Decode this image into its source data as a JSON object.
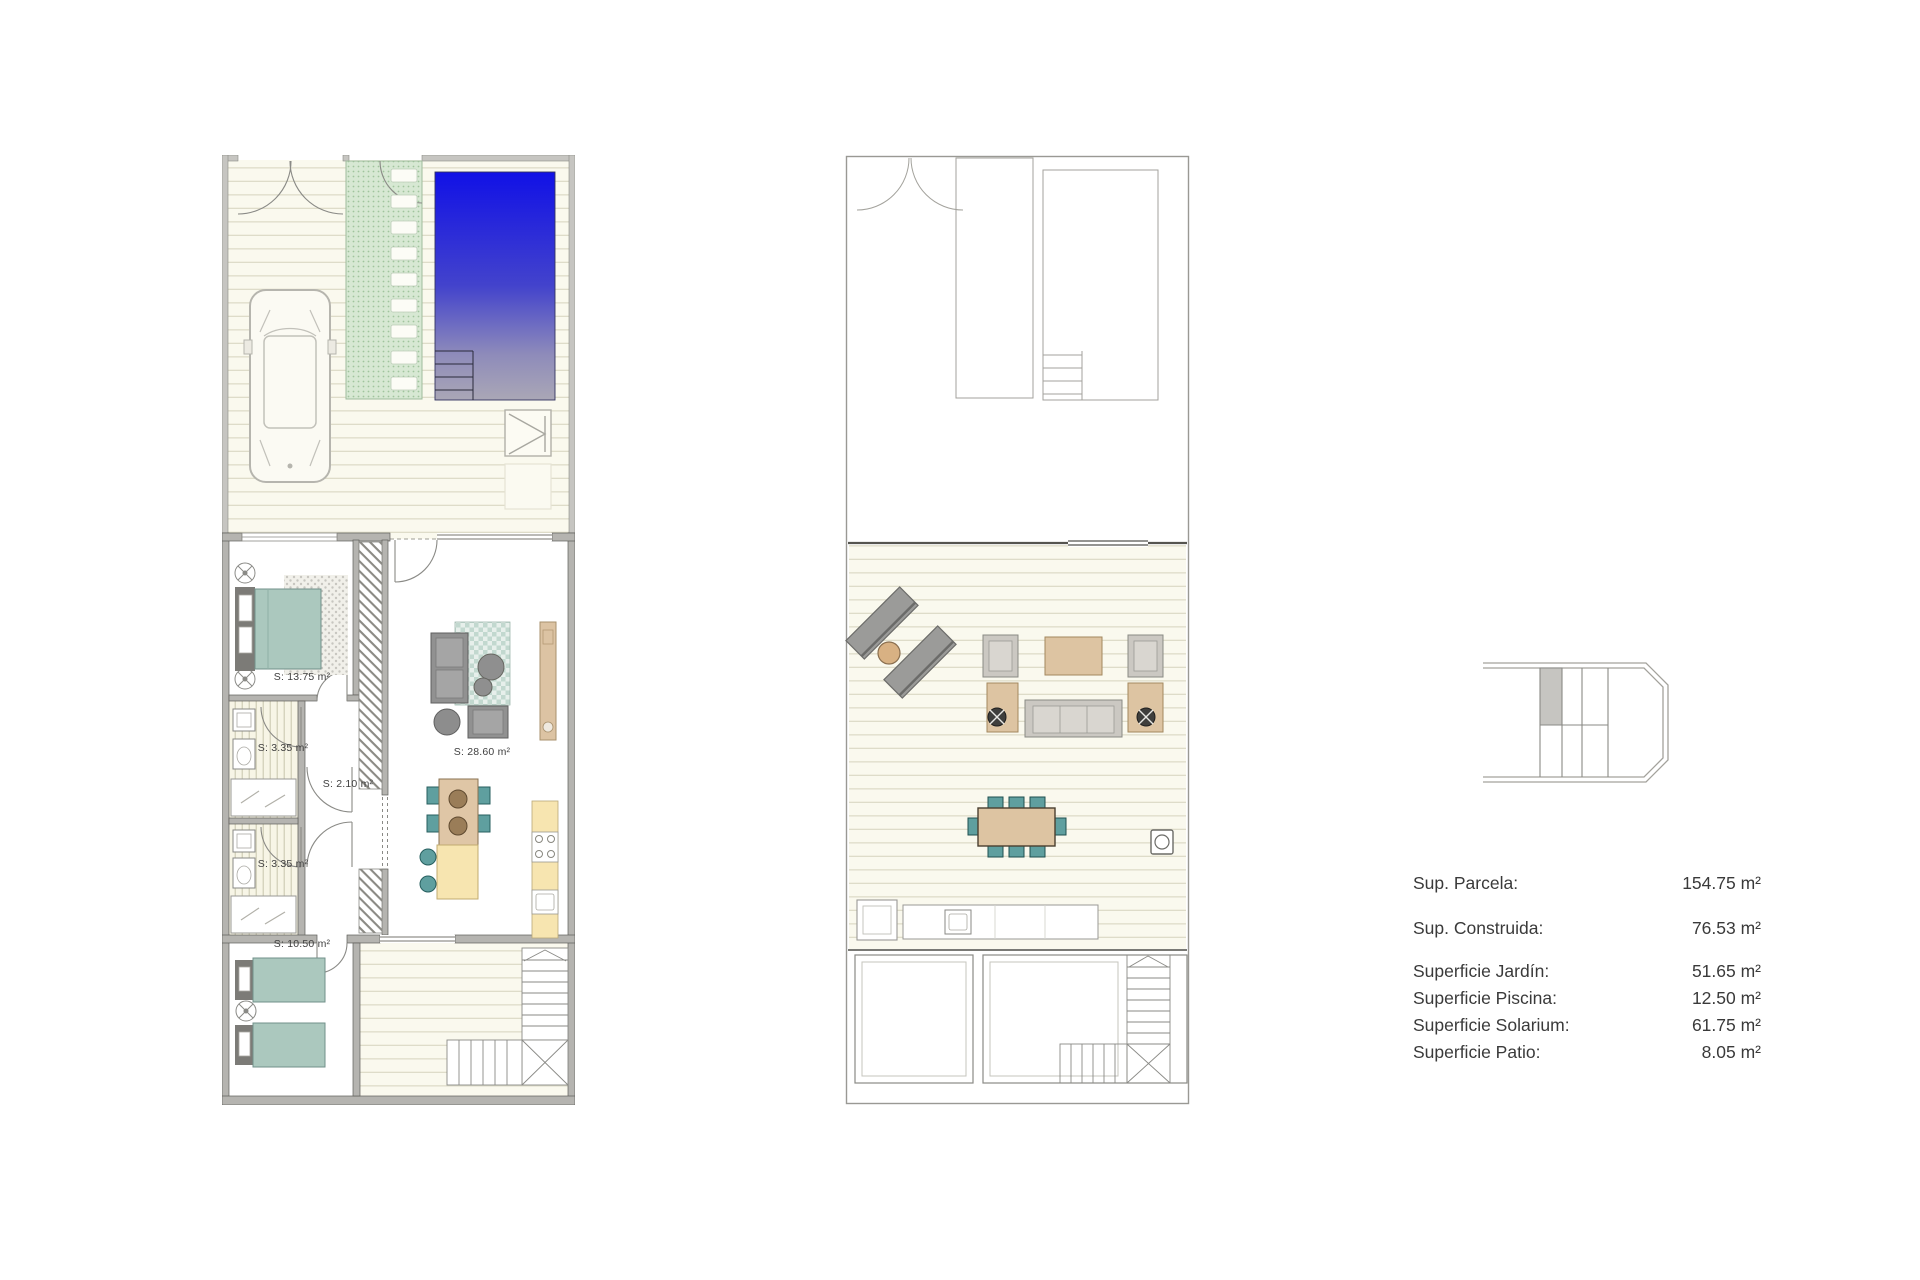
{
  "rooms": {
    "master_bedroom": "S: 13.75 m²",
    "bathroom_1": "S: 3.35 m²",
    "bathroom_2": "S: 3.35 m²",
    "hallway": "S: 2.10 m²",
    "living_kitchen": "S: 28.60 m²",
    "bedroom_2": "S: 10.50 m²"
  },
  "areas": [
    {
      "label": "Sup. Parcela:",
      "value": "154.75 m²"
    },
    {
      "label": "Sup. Construida:",
      "value": "76.53 m²"
    },
    {
      "label": "Superficie Jardín:",
      "value": "51.65 m²"
    },
    {
      "label": "Superficie Piscina:",
      "value": "12.50 m²"
    },
    {
      "label": "Superficie Solarium:",
      "value": "61.75 m²"
    },
    {
      "label": "Superficie Patio:",
      "value": "8.05 m²"
    }
  ],
  "colors": {
    "pool_blue": "#1111e6",
    "pool_fade": "#aaa7b6",
    "path_green": "#d7e8d3",
    "deck_cream": "#faf9ee",
    "furniture_teal": "#5f9f9f",
    "bed_teal": "#abc8be",
    "kitchen_yellow": "#f7e5b0",
    "wood_tan": "#ddc4a2",
    "sofa_gray": "#919191",
    "wall_gray": "#b5b4b0"
  }
}
